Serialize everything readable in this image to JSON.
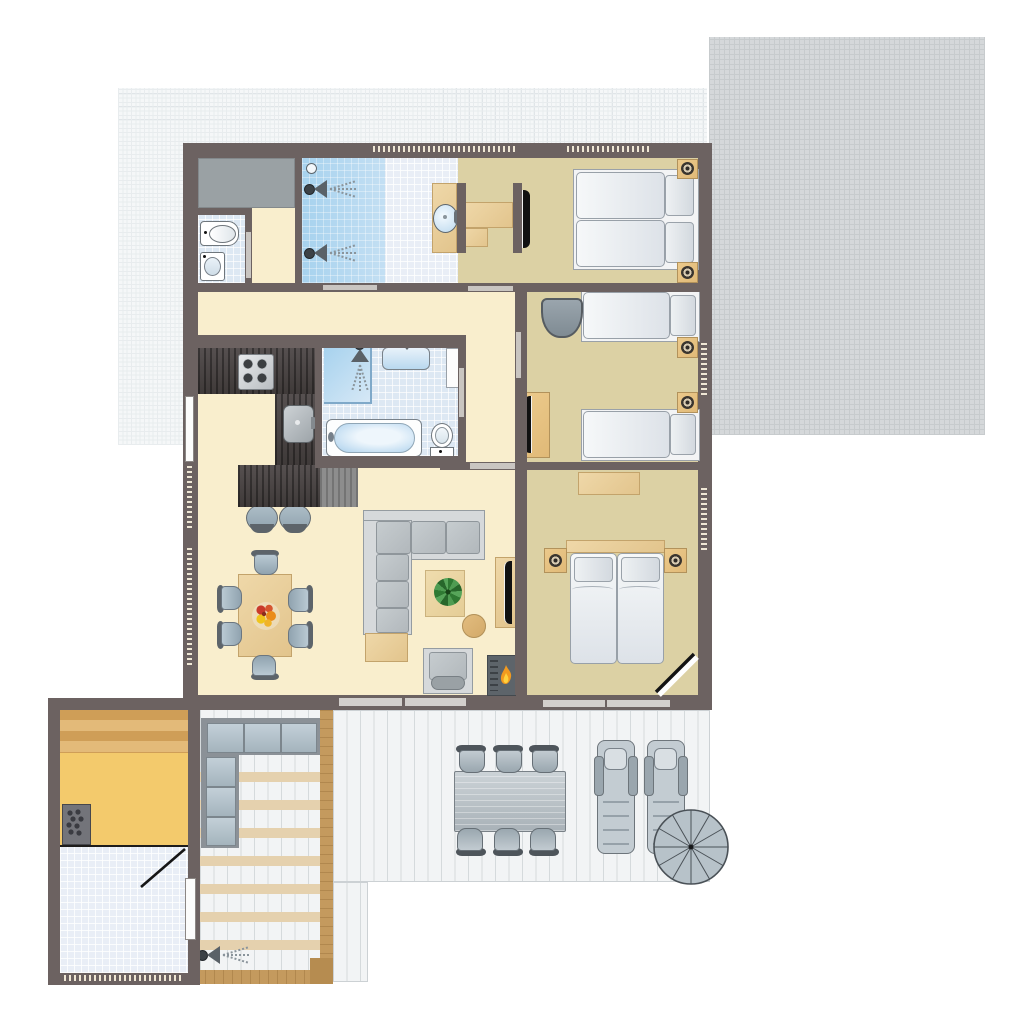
{
  "scene": {
    "kind": "floor-plan",
    "description": "Top-down architectural floor plan of a holiday lodge with three bedrooms, bathroom, sauna annex, covered veranda and wooden terrace",
    "has_visible_text": false
  },
  "palette": {
    "wall": "#6c6261",
    "floor_main": "#f9eecd",
    "floor_bedroom": "#dcd1a4",
    "floor_tile": "#dde8f3",
    "shower_blue": "#a7d2ee",
    "counter_dark": "#4c4645",
    "wood_light": "#ecd3a2",
    "wood_veranda": "#c49a5e",
    "sauna_yellow": "#f3ca6c",
    "gray_furniture": "#bdc3c7",
    "deck": "#f2f4f5",
    "grid_light": "#f5f7f8",
    "grid_dark": "#d5d8da",
    "flame_orange": "#f29a1f",
    "plant_green": "#357c38"
  },
  "exterior": {
    "patio_grid_light": {
      "label": "Light tiled patio (top left)"
    },
    "patio_grid_dark": {
      "label": "Dark tiled patio (top right)"
    },
    "terrace": {
      "label": "Wooden terrace",
      "furniture": [
        "outdoor dining table",
        "6 outdoor chairs",
        "2 sun loungers",
        "spiral staircase"
      ]
    },
    "veranda": {
      "label": "Covered veranda",
      "furniture": [
        "L-shaped lounge bench",
        "outdoor shower"
      ]
    }
  },
  "annex": {
    "sauna": {
      "label": "Sauna",
      "furniture": [
        "wooden bench",
        "sauna heater"
      ]
    },
    "shower_room": {
      "label": "Sauna shower room",
      "furniture": [
        "door"
      ]
    }
  },
  "rooms": {
    "storage": {
      "label": "Storage closet"
    },
    "toilet_room": {
      "label": "Toilet room",
      "furniture": [
        "toilet",
        "hand basin"
      ]
    },
    "shower_room": {
      "label": "Double shower room",
      "furniture": [
        "2 rain showers"
      ]
    },
    "washroom": {
      "label": "Washbasin area",
      "furniture": [
        "washbasin counter"
      ]
    },
    "bedroom1": {
      "label": "Bedroom 1",
      "furniture": [
        "double bed",
        "2 nightstands with lamps",
        "desk",
        "wall TV"
      ]
    },
    "bedroom2": {
      "label": "Bedroom 2",
      "furniture": [
        "2 single beds",
        "2 nightstands with lamps",
        "armchair",
        "dresser with TV"
      ]
    },
    "bathroom": {
      "label": "Bathroom",
      "furniture": [
        "corner shower",
        "washbasin",
        "bathtub",
        "toilet",
        "cabinet"
      ]
    },
    "kitchen": {
      "label": "Kitchen",
      "furniture": [
        "counter with stove",
        "sink",
        "island bar",
        "2 bar stools"
      ]
    },
    "living": {
      "label": "Living / dining room",
      "furniture": [
        "dining table with fruit bowl",
        "6 chairs",
        "corner sofa",
        "coffee table with plant",
        "side table",
        "TV cabinet",
        "lounge chair",
        "fireplace"
      ]
    },
    "bedroom3": {
      "label": "Master bedroom",
      "furniture": [
        "double bed",
        "2 nightstands with lamps",
        "dresser",
        "entrance door"
      ]
    },
    "hallway": {
      "label": "Hallway"
    }
  }
}
